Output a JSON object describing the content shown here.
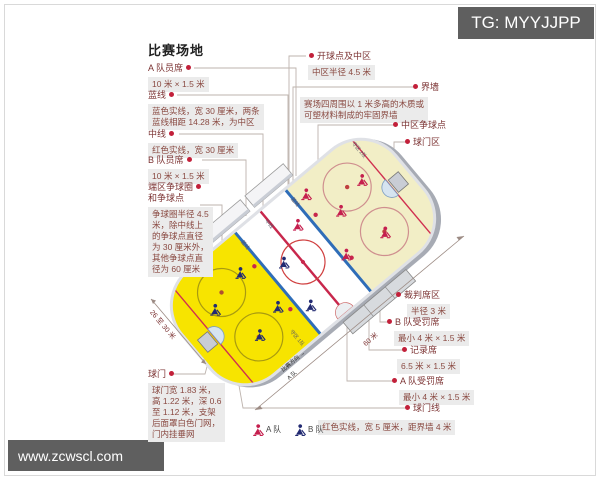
{
  "badges": {
    "tg": "TG: MYYJJPP",
    "site": "www.zcwscl.com"
  },
  "title": "比赛场地",
  "labels": {
    "left": [
      {
        "title": "A 队员席",
        "desc": "10 米 × 1.5 米"
      },
      {
        "title": "蓝线",
        "desc": "蓝色实线，宽 30 厘米，两条\n蓝线相距 14.28 米，为中区"
      },
      {
        "title": "中线",
        "desc": "红色实线，宽 30 厘米"
      },
      {
        "title": "B 队员席",
        "desc": "10 米 × 1.5 米"
      },
      {
        "title": "端区争球圈\n和争球点",
        "desc": "争球圈半径 4.5\n米，除中线上\n的争球点直径\n为 30 厘米外，\n其他争球点直\n径为 60 厘米"
      },
      {
        "title": "球门",
        "desc": "球门宽 1.83 米，\n高 1.22 米，深 0.6\n至 1.12 米，支架\n后面罩白色门网，\n门内挂垂网"
      }
    ],
    "right": [
      {
        "title": "开球点及中区",
        "desc": "中区半径 4.5 米"
      },
      {
        "title": "界墙",
        "desc": "赛场四周围以 1 米多高的木质或\n可塑材料制成的牢固界墙"
      },
      {
        "title": "中区争球点",
        "desc": ""
      },
      {
        "title": "球门区",
        "desc": ""
      },
      {
        "title": "裁判席区",
        "desc": "半径 3 米"
      },
      {
        "title": "B 队受罚席",
        "desc": "最小 4 米 × 1.5 米"
      },
      {
        "title": "记录席",
        "desc": "6.5 米 × 1.5 米"
      },
      {
        "title": "A 队受罚席",
        "desc": "最小 4 米 × 1.5 米"
      },
      {
        "title": "球门线",
        "desc": "红色实线，宽 5 厘米，距界墙 4 米"
      }
    ]
  },
  "legend": [
    {
      "team": "A 队",
      "color": "#c51f4e"
    },
    {
      "team": "B 队",
      "color": "#222a72"
    }
  ],
  "rink": {
    "dim_width": "26 至 30 米",
    "dim_length": "60 米",
    "direction": "比赛方向 →",
    "direction_team": "A 队",
    "ice_labels": {
      "blue_line": "蓝线",
      "center_line": "中线",
      "zone_a": "守区 1队",
      "zone_b": "守区 2队"
    }
  },
  "colors": {
    "rink_yellow": "#f7e400",
    "rink_cream": "#f2eec6",
    "blue_line": "#2f6db8",
    "red_line": "#c8274c",
    "team_a": "#c51f4e",
    "team_b": "#222a72",
    "badge_bg": "#5f5f5f",
    "chip_bg": "#ebebeb",
    "label_text": "#7c3333"
  }
}
